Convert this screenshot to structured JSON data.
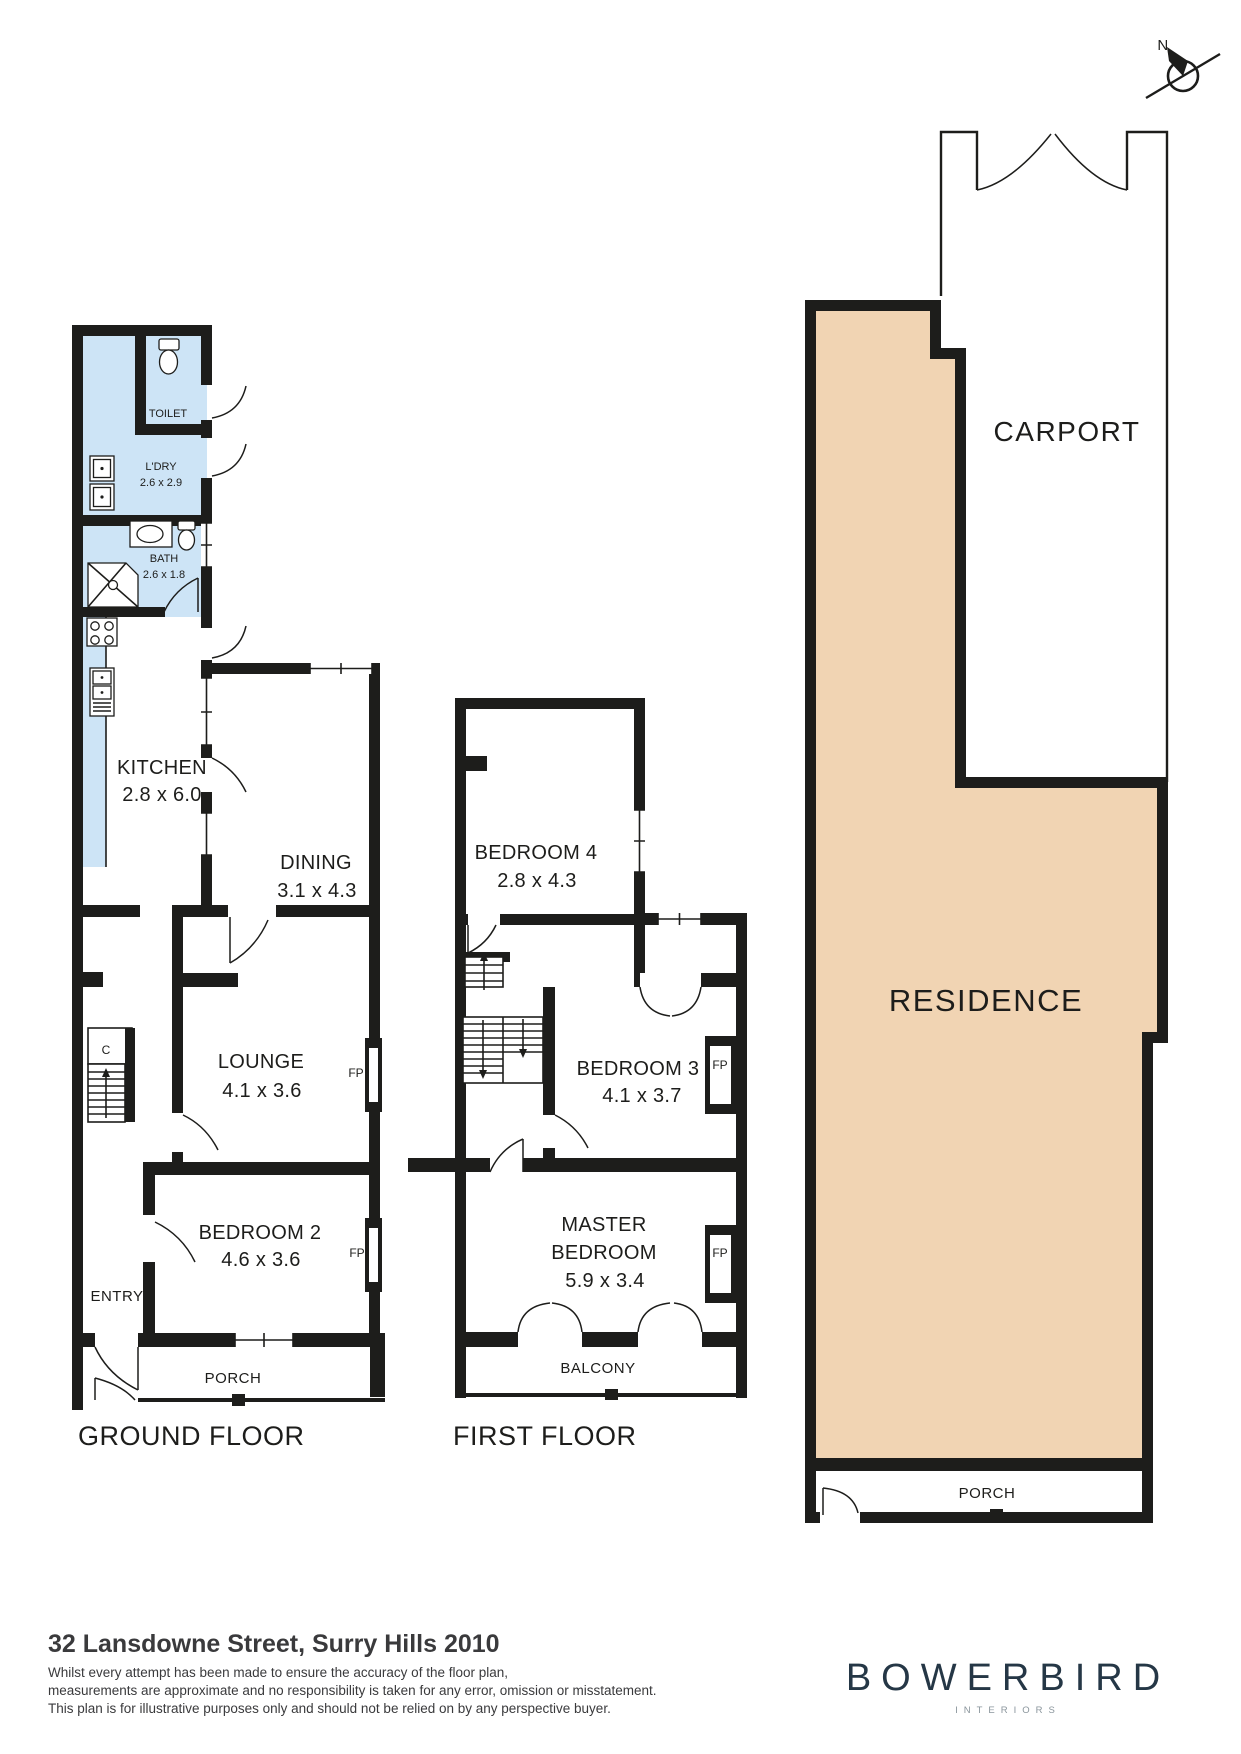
{
  "compass": {
    "north_label": "N"
  },
  "site_plan": {
    "carport_label": "CARPORT",
    "residence_label": "RESIDENCE",
    "porch_label": "PORCH"
  },
  "ground_floor": {
    "title": "GROUND FLOOR",
    "closet_label": "C",
    "fireplace_label": "FP",
    "rooms": {
      "toilet": {
        "name": "TOILET"
      },
      "laundry": {
        "name": "L'DRY",
        "dims": "2.6 x 2.9"
      },
      "bath": {
        "name": "BATH",
        "dims": "2.6 x 1.8"
      },
      "kitchen": {
        "name": "KITCHEN",
        "dims": "2.8 x 6.0"
      },
      "dining": {
        "name": "DINING",
        "dims": "3.1 x 4.3"
      },
      "lounge": {
        "name": "LOUNGE",
        "dims": "4.1 x 3.6"
      },
      "bedroom2": {
        "name": "BEDROOM 2",
        "dims": "4.6 x 3.6"
      },
      "entry": {
        "name": "ENTRY"
      },
      "porch": {
        "name": "PORCH"
      }
    }
  },
  "first_floor": {
    "title": "FIRST FLOOR",
    "fireplace_label": "FP",
    "rooms": {
      "bedroom4": {
        "name": "BEDROOM 4",
        "dims": "2.8 x 4.3"
      },
      "bedroom3": {
        "name": "BEDROOM 3",
        "dims": "4.1 x 3.7"
      },
      "master": {
        "name_line1": "MASTER",
        "name_line2": "BEDROOM",
        "dims": "5.9 x 3.4"
      },
      "balcony": {
        "name": "BALCONY"
      }
    }
  },
  "footer": {
    "address": "32 Lansdowne Street, Surry Hills 2010",
    "disclaimer_line1": "Whilst every attempt has been made to ensure the accuracy of the floor plan,",
    "disclaimer_line2": "measurements are approximate and no responsibility is taken for any error, omission or misstatement.",
    "disclaimer_line3": "This plan is for illustrative purposes only and should not be relied on by any perspective buyer.",
    "brand": "BOWERBIRD",
    "brand_sub": "INTERIORS"
  },
  "colors": {
    "wall": "#1d1d1b",
    "wet_room_fill": "#cde4f6",
    "residence_fill": "#f1d4b3",
    "brand_navy": "#253746",
    "text_dark": "#3a3a3c",
    "brand_sub_gray": "#8a959c"
  }
}
